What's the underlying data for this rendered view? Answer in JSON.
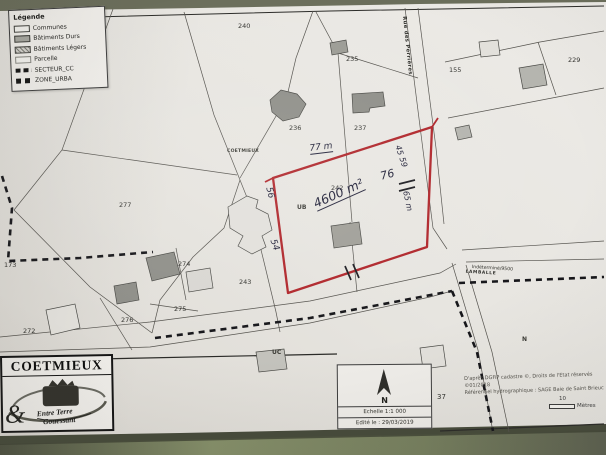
{
  "colors": {
    "outline_red": "#b0262b",
    "paper": "#e9e7e2"
  },
  "legend": {
    "title": "Légende",
    "items": [
      {
        "label": "Communes"
      },
      {
        "label": "Bâtiments Durs"
      },
      {
        "label": "Bâtiments Légers"
      },
      {
        "label": "Parcelle"
      },
      {
        "label": "SECTEUR_CC"
      },
      {
        "label": "ZONE_URBA"
      }
    ]
  },
  "map": {
    "place_label": "COETMIEUX",
    "street_label": "Rue des Perrières",
    "road_label_line1": "Indéterminé/9500",
    "road_label_line2": "LAMBALLE",
    "zone_labels": {
      "ub": "UB",
      "uc": "UC",
      "n": "N"
    },
    "parcels": {
      "p240": "240",
      "p235": "235",
      "p236": "236",
      "p237": "237",
      "p229": "229",
      "p155": "155",
      "p277": "277",
      "p173": "173",
      "p274": "274",
      "p243": "243",
      "p275": "275",
      "p276": "276",
      "p272": "272",
      "p242": "242",
      "p37": "37"
    },
    "annotations": {
      "top_length": "77 m",
      "area": "4600 m²",
      "width": "76",
      "left_upper": "56",
      "left_lower": "54",
      "right_upper": "45",
      "right_mid": "59",
      "right_length": "65 m"
    }
  },
  "footer": {
    "commune_box": {
      "title": "COETMIEUX",
      "ampersand": "&",
      "logo_line1": "Entre Terre",
      "logo_line2": "Gouessant"
    },
    "north_box": {
      "north": "N",
      "scale": "Echelle 1:1 000",
      "edited": "Edité le : 29/03/2019"
    },
    "credits": {
      "line1": "D'après DGFiP cadastre ©, Droits de l'Etat réservés ©01/2018",
      "line2": "Référentiel hydrographique : SAGE Baie de Saint Brieuc"
    },
    "scalebar": {
      "value": "10",
      "unit": "Mètres"
    }
  }
}
